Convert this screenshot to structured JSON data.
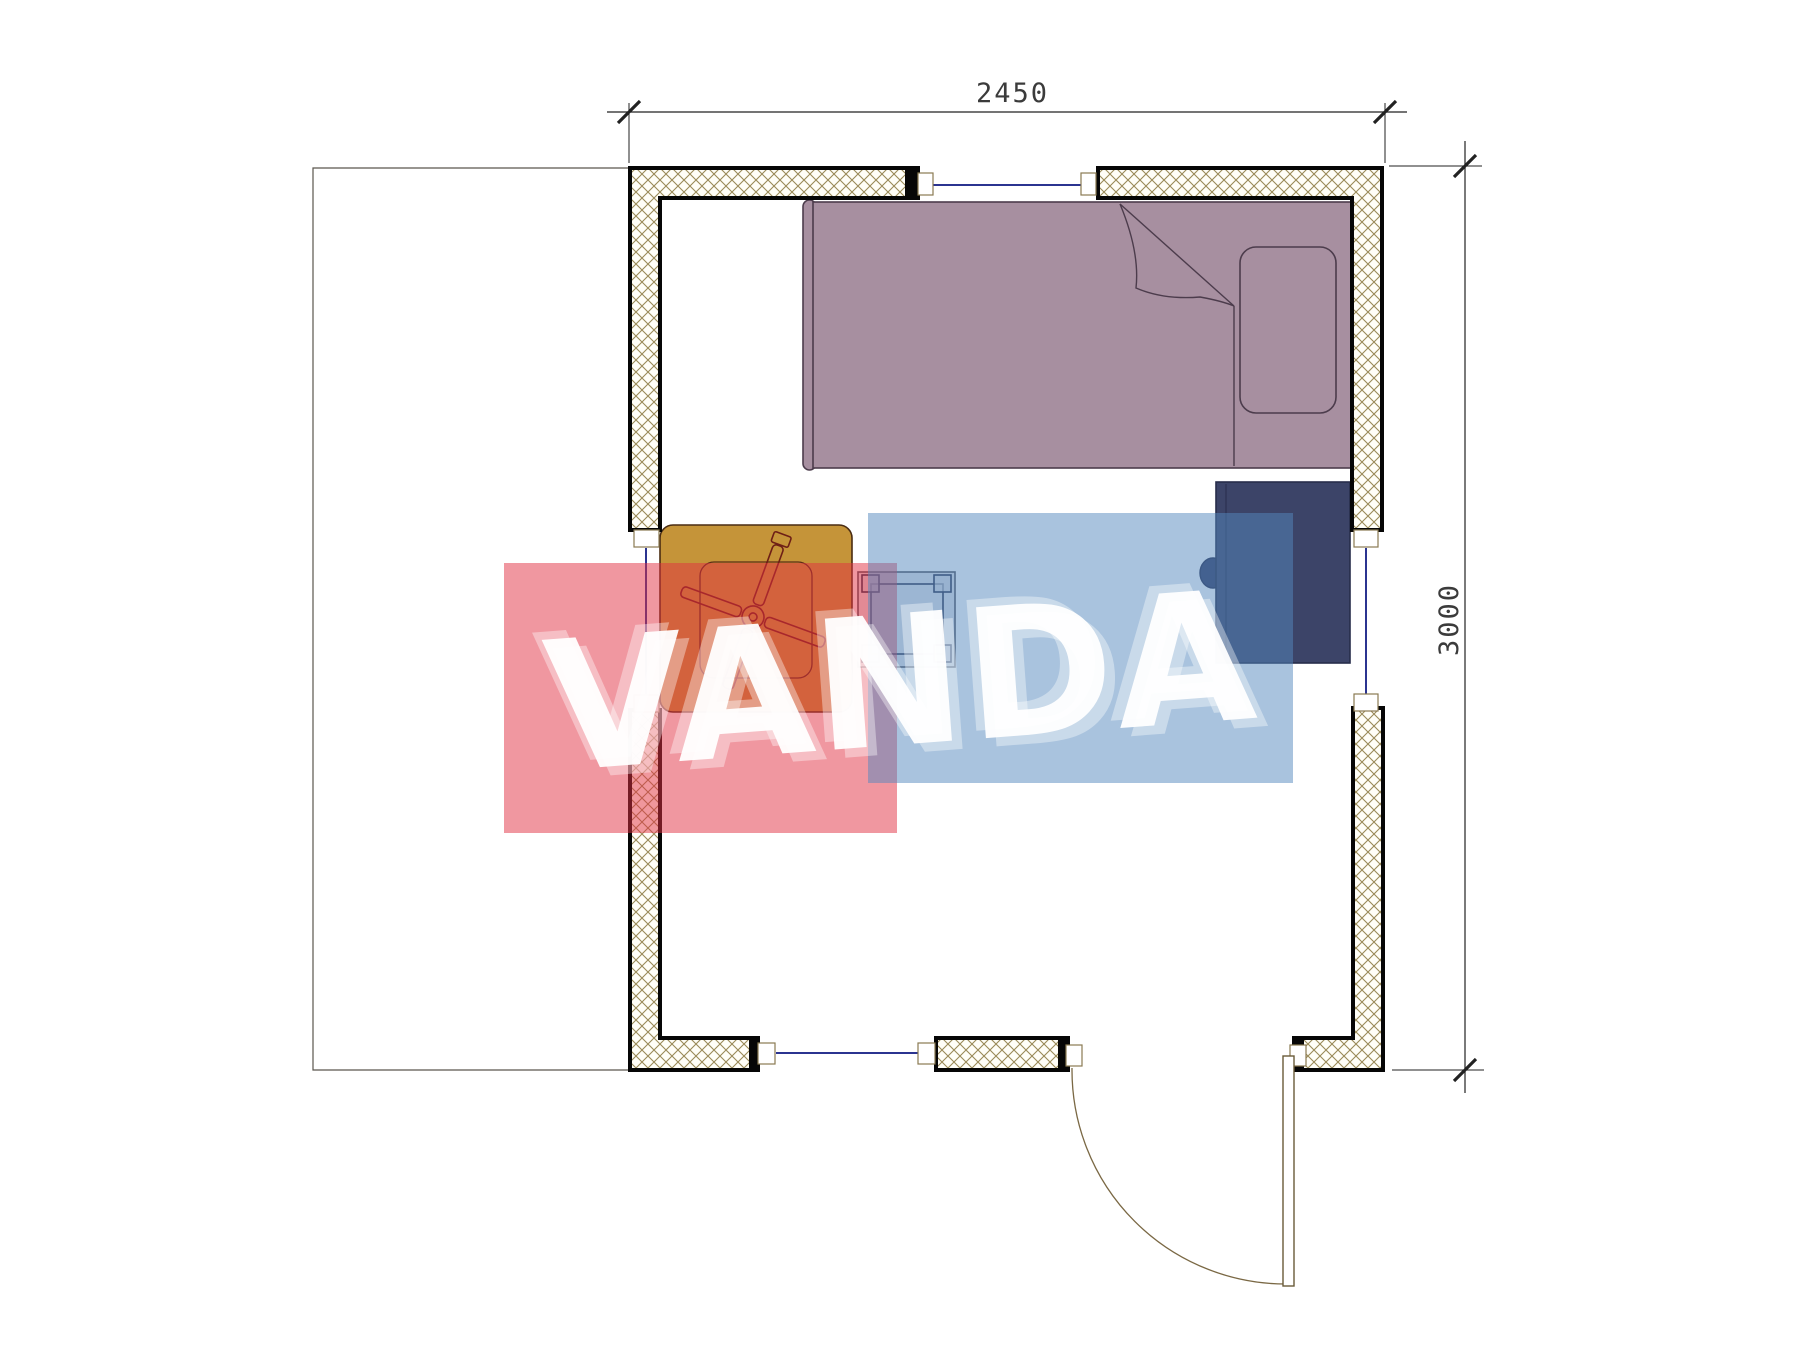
{
  "title": "Garden cabin floor plan drawing",
  "dimensions": {
    "top_label": "2450",
    "right_label": "3000"
  },
  "watermark": {
    "text": "VANDA",
    "red_block_color": "#e23042",
    "blue_block_color": "#5488be"
  },
  "colors": {
    "bed": "#a78fa0",
    "bed_outline": "#4c3c4c",
    "desk": "#3c4468",
    "chair": "#333a63",
    "table": "#c59439",
    "table_outline": "#4a2c12",
    "fan_outline": "#6e1f16",
    "stool_fill": "#cfd0d6",
    "stool_outline": "#2b3350",
    "wall_hatch_line": "#9a8a58",
    "window_line": "#2b3490",
    "door_line": "#7a6844",
    "dimension_line": "#222222",
    "dimension_text": "#3b3b3b"
  },
  "elements": {
    "walls": "insulated exterior walls with cross-hatch fill",
    "openings": "three windows and one entrance door with swing arc",
    "furniture": "single bed with pillow, desk with chair, square table with fan, stool",
    "outside": "terrace outline on the left"
  }
}
